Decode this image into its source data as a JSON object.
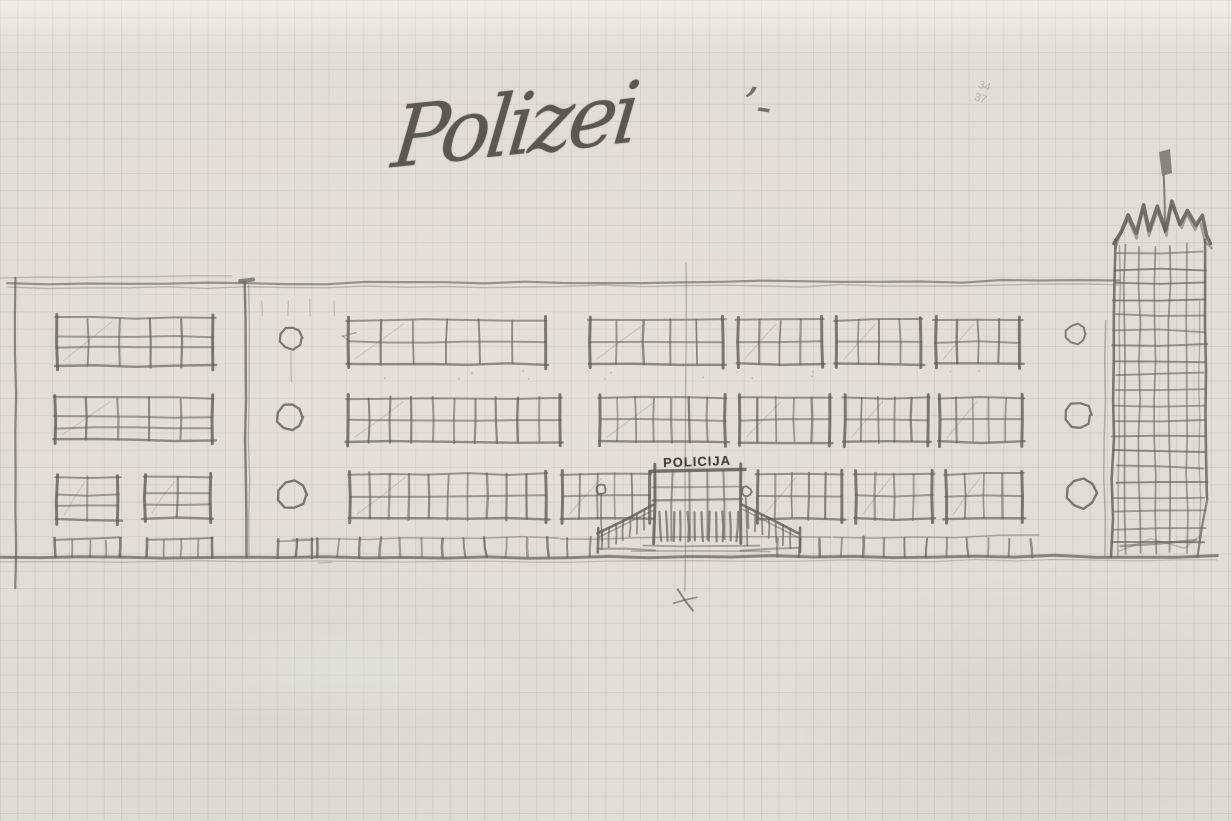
{
  "artwork": {
    "title_handwritten": "Polizei",
    "title_flourish": "’-",
    "door_sign": "POLICIJA",
    "faint_note": "34\n37"
  },
  "colors": {
    "paper": "#e1ded7",
    "grid_line": "#c6ccc3",
    "pencil": "#5f5f56",
    "pencil_light": "#8b8b80"
  }
}
